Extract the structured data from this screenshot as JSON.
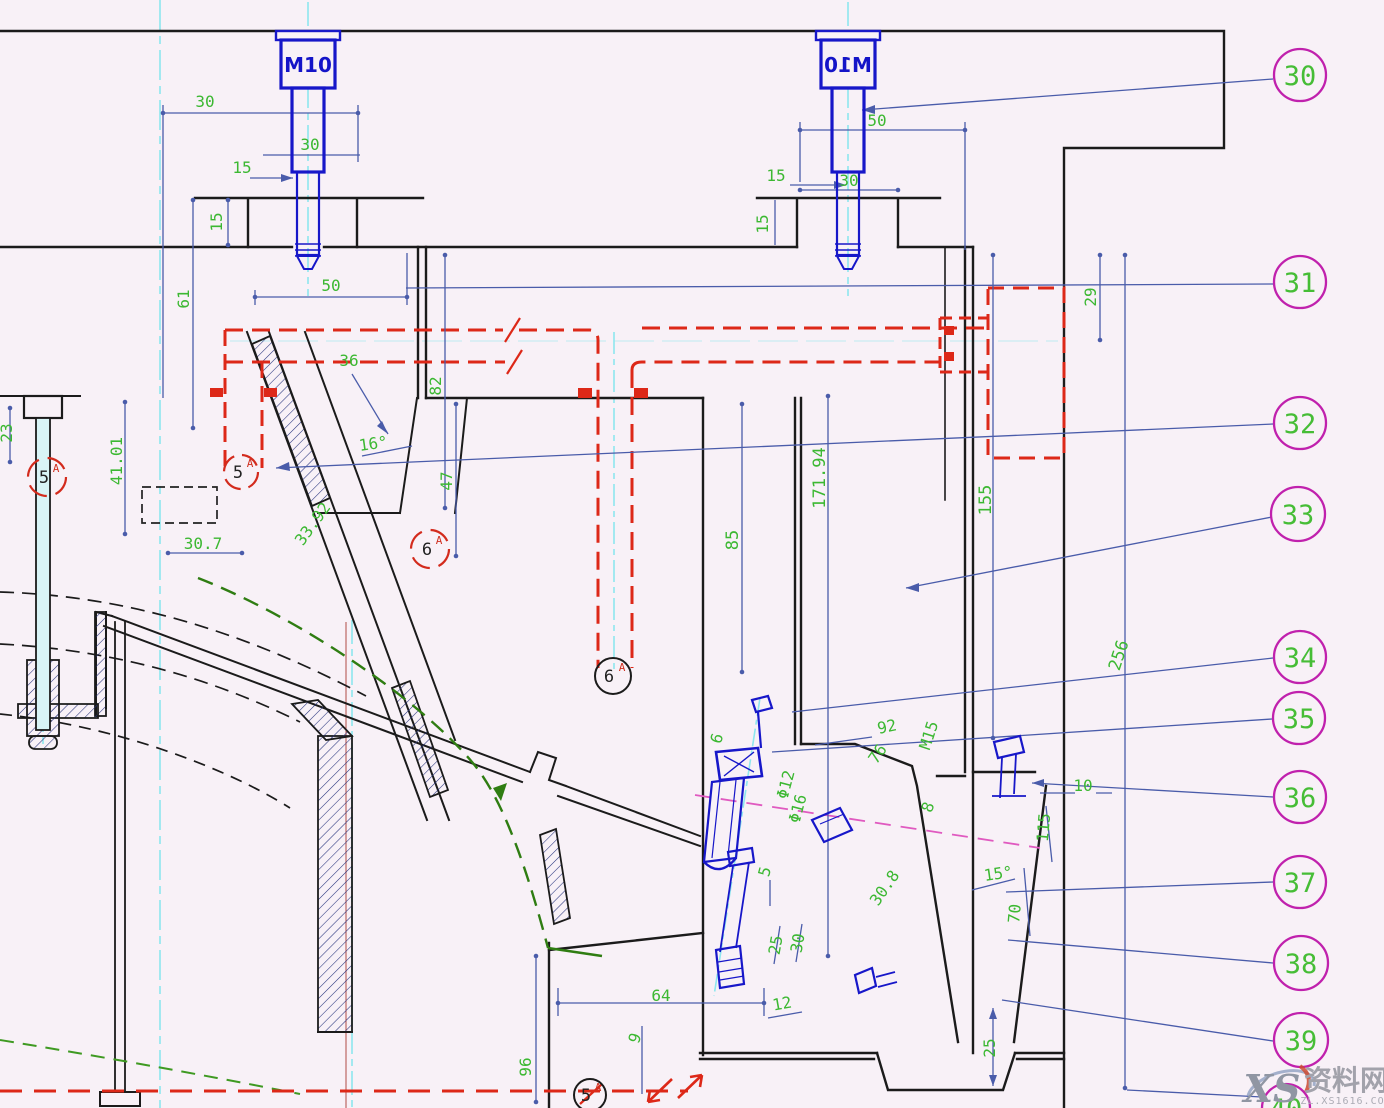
{
  "drawing_type": "mold-assembly-section-cad-drawing",
  "colors": {
    "background": "#f8f1f7",
    "outline_black": "#1b1b1b",
    "dim_line_blue": "#4a5caa",
    "dim_text_green": "#3cb832",
    "bolt_blue": "#1717c9",
    "cooling_red": "#dd2818",
    "centerline_cyan": "#8ee7ee",
    "balloon_magenta": "#c021ad",
    "profile_green_dash": "#2f7d12",
    "magenta_dash": "#e05ac0"
  },
  "bolts": {
    "label": "M10"
  },
  "balloons": [
    "30",
    "31",
    "32",
    "33",
    "34",
    "35",
    "36",
    "37",
    "38",
    "39",
    "40"
  ],
  "dim_labels": {
    "tl": [
      "30",
      "30",
      "15",
      "15",
      "61",
      "50"
    ],
    "slide": [
      "36",
      "82",
      "16°",
      "33.92",
      "47"
    ],
    "left": [
      "23",
      "41.01",
      "30.7"
    ],
    "tr": [
      "50",
      "30",
      "15",
      "15",
      "29"
    ],
    "center": [
      "85",
      "171.94",
      "155",
      "256"
    ],
    "mr": [
      "92",
      "76",
      "M15",
      "10",
      "115",
      "15°",
      "70",
      "30.8",
      "8"
    ],
    "ej": [
      "Φ12",
      "Φ16",
      "6",
      "5"
    ],
    "bottom": [
      "64",
      "96",
      "9",
      "25",
      "30",
      "12",
      "25"
    ]
  },
  "sections": [
    {
      "n": "5",
      "s": "A"
    },
    {
      "n": "5",
      "s": "A"
    },
    {
      "n": "6",
      "s": "A"
    },
    {
      "n": "6",
      "s": "A"
    },
    {
      "n": "5",
      "s": "A"
    }
  ],
  "watermark": {
    "logo": "XS",
    "site": "资料网",
    "domain": "ZL.XS1616.COM"
  }
}
